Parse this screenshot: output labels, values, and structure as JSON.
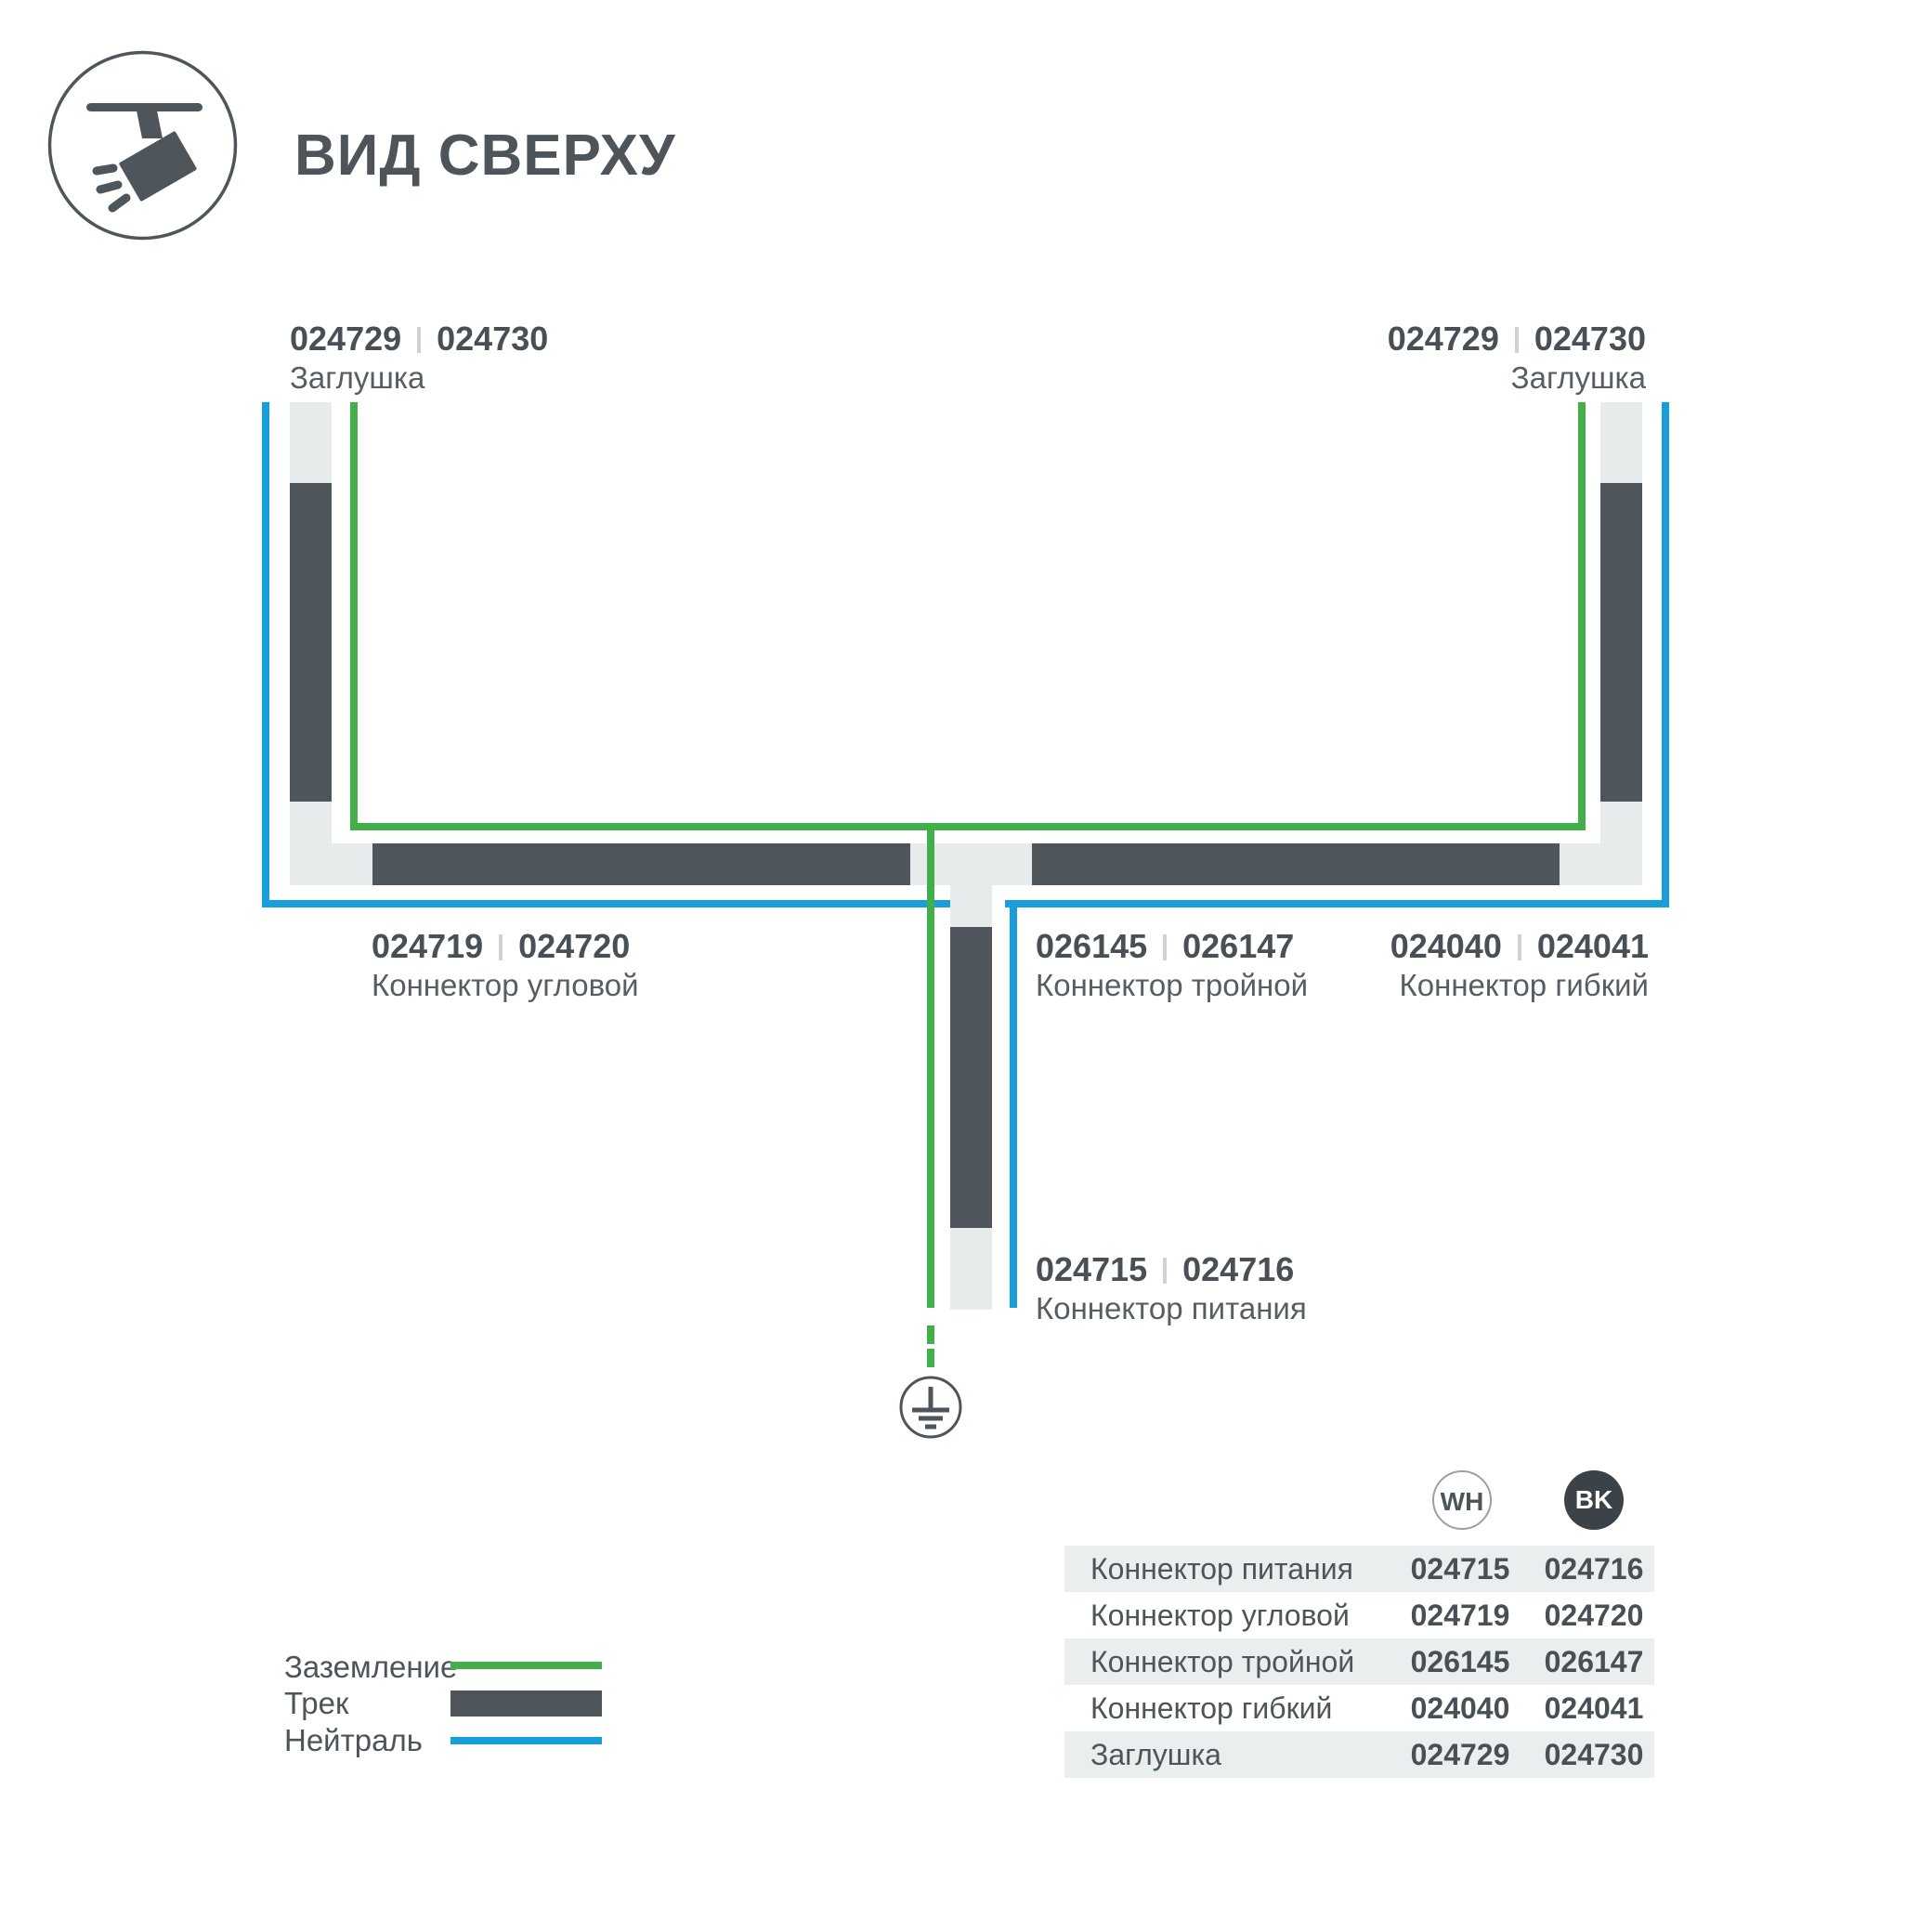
{
  "header": {
    "title": "ВИД СВЕРХУ",
    "icon": "track-spotlight"
  },
  "diagram": {
    "callouts": {
      "cap_top_left": {
        "code_wh": "024729",
        "code_bk": "024730",
        "label": "Заглушка"
      },
      "cap_top_right": {
        "code_wh": "024729",
        "code_bk": "024730",
        "label": "Заглушка"
      },
      "corner_connector": {
        "code_wh": "024719",
        "code_bk": "024720",
        "label": "Коннектор угловой"
      },
      "triple_connector": {
        "code_wh": "026145",
        "code_bk": "026147",
        "label": "Коннектор тройной"
      },
      "flex_connector": {
        "code_wh": "024040",
        "code_bk": "024041",
        "label": "Коннектор гибкий"
      },
      "power_connector": {
        "code_wh": "024715",
        "code_bk": "024716",
        "label": "Коннектор питания"
      }
    },
    "ground_symbol": "earth-ground"
  },
  "legend": {
    "items": [
      {
        "label": "Заземление",
        "swatch": "ground-line",
        "color": "#42af4a"
      },
      {
        "label": "Трек",
        "swatch": "track-bar",
        "color": "#4e565c"
      },
      {
        "label": "Нейтраль",
        "swatch": "neutral-line",
        "color": "#189fd9"
      }
    ]
  },
  "table": {
    "columns": [
      {
        "label": "WH",
        "variant": "white"
      },
      {
        "label": "BK",
        "variant": "black"
      }
    ],
    "rows": [
      {
        "label": "Коннектор питания",
        "wh": "024715",
        "bk": "024716"
      },
      {
        "label": "Коннектор угловой",
        "wh": "024719",
        "bk": "024720"
      },
      {
        "label": "Коннектор тройной",
        "wh": "026145",
        "bk": "026147"
      },
      {
        "label": "Коннектор гибкий",
        "wh": "024040",
        "bk": "024041"
      },
      {
        "label": "Заглушка",
        "wh": "024729",
        "bk": "024730"
      }
    ]
  },
  "colors": {
    "track": "#4e565c",
    "ground_line": "#42af4a",
    "neutral_line": "#189fd9",
    "connector_fill": "#e8ebeb",
    "table_row_alt": "#ebeeee",
    "text_dark": "#484f55",
    "text_caption": "#575e63",
    "bk_badge": "#3c4348"
  }
}
